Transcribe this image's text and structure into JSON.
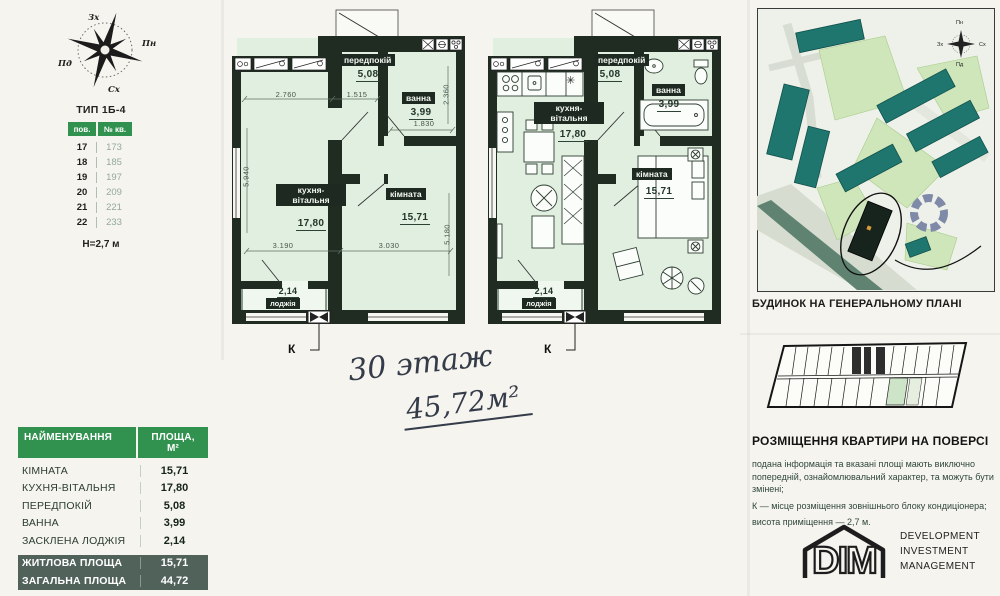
{
  "compass_main": {
    "top": "Зх",
    "right": "Пн",
    "left": "Пд",
    "bottom": "Сх"
  },
  "compass_site": {
    "top": "Пн",
    "right": "Сх",
    "left": "Зх",
    "bottom": "Пд"
  },
  "type_table": {
    "title": "ТИП 1Б-4",
    "col_floor": "пов.",
    "col_apt": "№ кв.",
    "rows": [
      {
        "floor": "17",
        "apt": "173"
      },
      {
        "floor": "18",
        "apt": "185"
      },
      {
        "floor": "19",
        "apt": "197"
      },
      {
        "floor": "20",
        "apt": "209"
      },
      {
        "floor": "21",
        "apt": "221"
      },
      {
        "floor": "22",
        "apt": "233"
      }
    ],
    "height_note": "Н=2,7 м"
  },
  "plan": {
    "rooms": {
      "hallway": {
        "name": "передпокій",
        "area": "5,08"
      },
      "bath": {
        "name": "ванна",
        "area": "3,99"
      },
      "kitchen": {
        "name": "кухня-вітальня",
        "area": "17,80"
      },
      "room": {
        "name": "кімната",
        "area": "15,71"
      },
      "loggia": {
        "name": "лоджія",
        "area": "2,14"
      }
    },
    "dims": {
      "w_kitchen": "2.760",
      "w_hall": "1.515",
      "w_bath": "1.830",
      "h_bath": "2.360",
      "h_kitchen": "5.940",
      "h_room": "5.180",
      "wi_kitchen": "3.190",
      "wi_room": "3.030"
    },
    "k_label": "К"
  },
  "handwriting": {
    "line1": "30 этаж",
    "line2": "45,72м²"
  },
  "area_table": {
    "header_name": "НАЙМЕНУВАННЯ",
    "header_area": "ПЛОЩА, М²",
    "rows": [
      {
        "name": "КІМНАТА",
        "area": "15,71"
      },
      {
        "name": "КУХНЯ-ВІТАЛЬНЯ",
        "area": "17,80"
      },
      {
        "name": "ПЕРЕДПОКІЙ",
        "area": "5,08"
      },
      {
        "name": "ВАННА",
        "area": "3,99"
      },
      {
        "name": "ЗАСКЛЕНА ЛОДЖІЯ",
        "area": "2,14"
      }
    ],
    "totals": [
      {
        "name": "ЖИТЛОВА ПЛОЩА",
        "area": "15,71"
      },
      {
        "name": "ЗАГАЛЬНА ПЛОЩА",
        "area": "44,72"
      }
    ]
  },
  "site_plan": {
    "caption": "БУДИНОК НА ГЕНЕРАЛЬНОМУ ПЛАНІ"
  },
  "floor_section": {
    "heading": "РОЗМІЩЕННЯ КВАРТИРИ НА ПОВЕРСІ",
    "disclaimer_1": "подана інформація та вказані площі мають виключно попередній, ознайомлювальний характер, та можуть бути змінені;",
    "disclaimer_2": "К — місце розміщення зовнішнього блоку кондиціонера;",
    "disclaimer_3": "висота приміщення — 2,7 м."
  },
  "logo": {
    "text": "DIM",
    "line1": "DEVELOPMENT",
    "line2": "INVESTMENT",
    "line3": "MANAGEMENT"
  },
  "icons": {
    "snowflake": "✳"
  }
}
